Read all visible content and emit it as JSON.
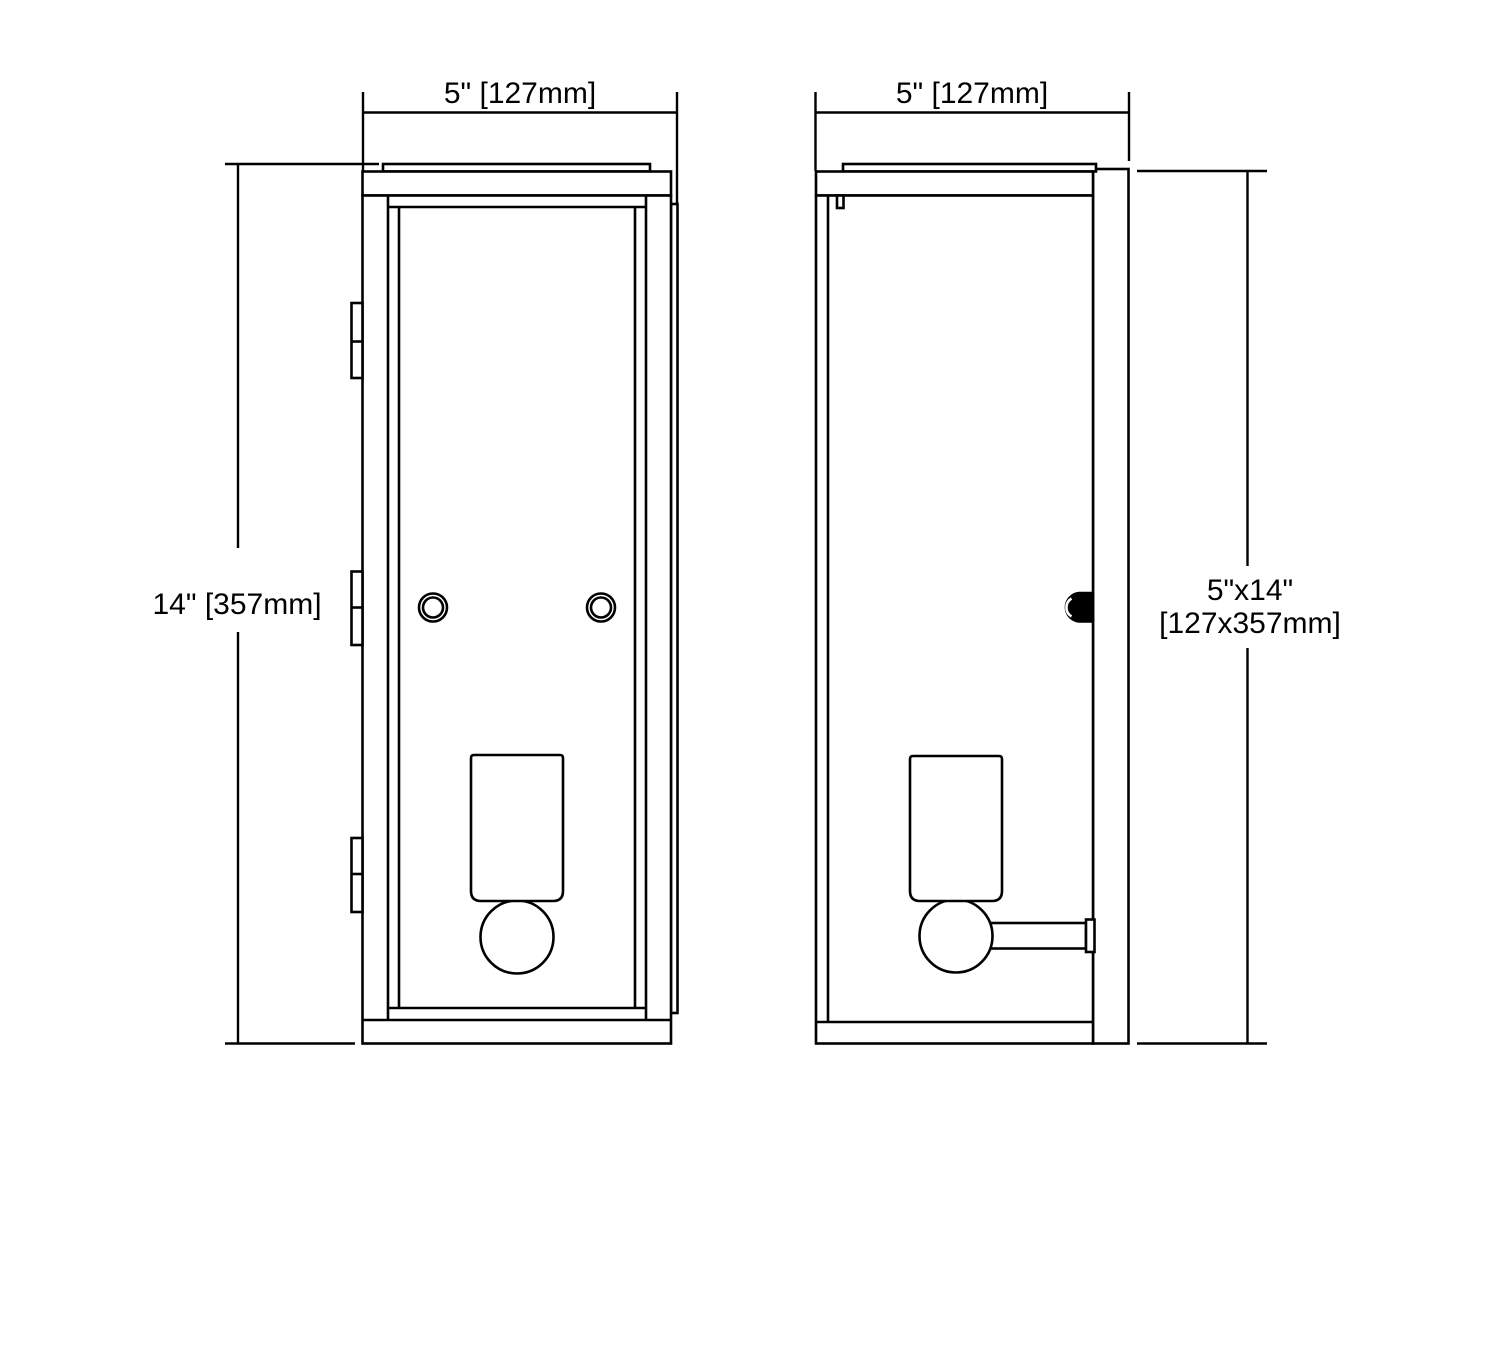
{
  "page": {
    "background_color": "#ffffff",
    "line_color": "#000000"
  },
  "drawing": {
    "type": "technical-dimension-drawing",
    "subject": "wall-sconce-two-views",
    "front": {
      "width_label": "5\" [127mm]",
      "height_label": "14\" [357mm]"
    },
    "side": {
      "width_label": "5\" [127mm]",
      "size_label_line1": "5\"x14\"",
      "size_label_line2": "[127x357mm]"
    }
  }
}
